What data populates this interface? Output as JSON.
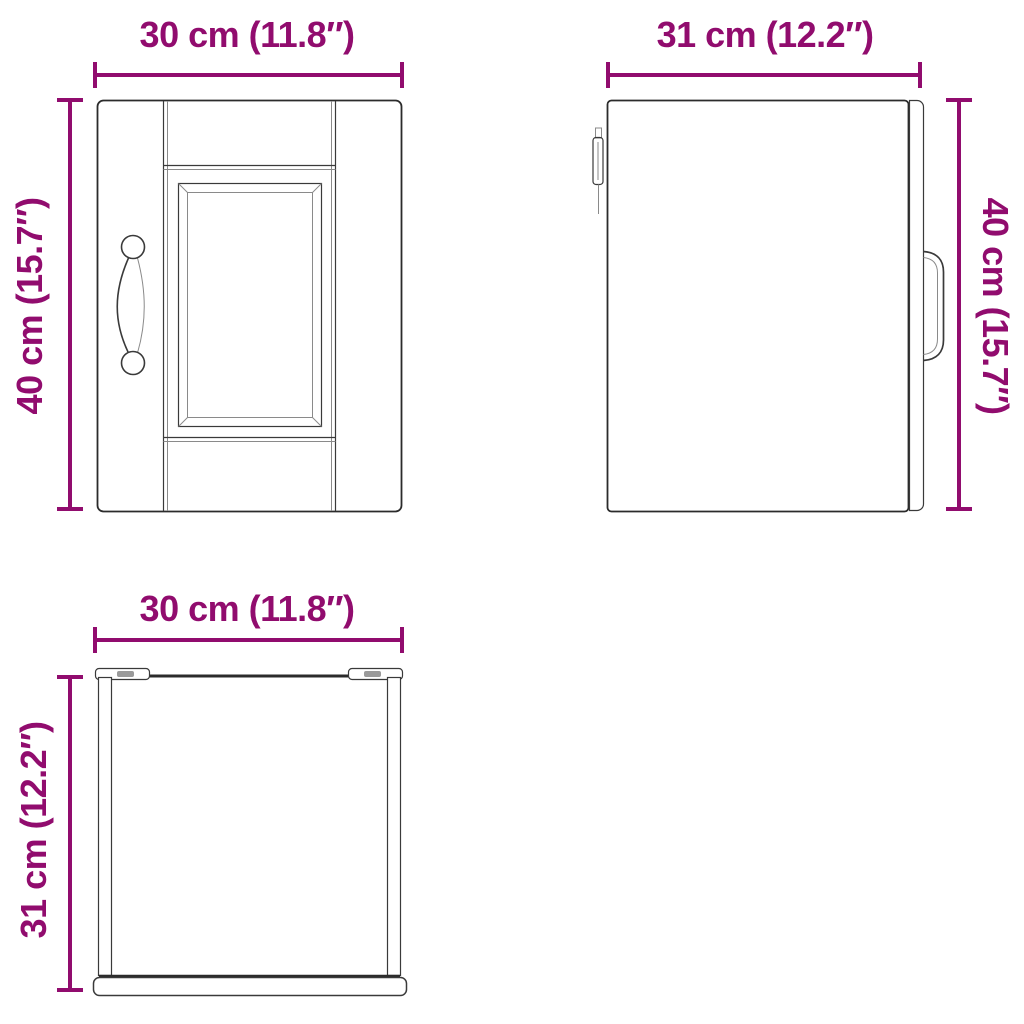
{
  "colors": {
    "accent": "#910C6E",
    "line": "#2b2b2b"
  },
  "views": {
    "front": {
      "title": "front-view",
      "width_label": "30 cm (11.8″)",
      "height_label": "40 cm (15.7″)"
    },
    "side": {
      "title": "side-view",
      "width_label": "31 cm (12.2″)",
      "height_label": "40 cm (15.7″)"
    },
    "top": {
      "title": "top-view",
      "width_label": "30 cm (11.8″)",
      "depth_label": "31 cm (12.2″)"
    }
  }
}
